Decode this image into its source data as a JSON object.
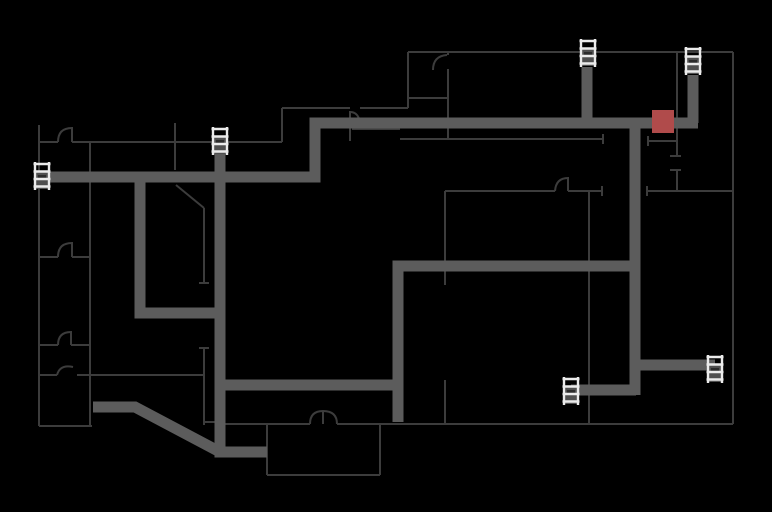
{
  "screen": {
    "kind": "game-automap",
    "width": 772,
    "height": 512
  },
  "map": {
    "colors": {
      "background": "#000000",
      "wall": "#3c3c3c",
      "path": "#5c5c5c",
      "ladder": "#ebebeb",
      "ladder_inner": "#4f4f4f",
      "ladder_slot": "#2b2b2b",
      "marker": "#b04b4b"
    },
    "wall_width": 2,
    "path_width": 11,
    "walls": [
      [
        39,
        125,
        39,
        426
      ],
      [
        39,
        142,
        58,
        142
      ],
      [
        72,
        142,
        282,
        142
      ],
      [
        39,
        257,
        58,
        257
      ],
      [
        72,
        257,
        90,
        257
      ],
      [
        39,
        345,
        58,
        345
      ],
      [
        71,
        345,
        90,
        345
      ],
      [
        39,
        375,
        57,
        375
      ],
      [
        77,
        375,
        203,
        375
      ],
      [
        39,
        426,
        92,
        426
      ],
      [
        90,
        142,
        90,
        426
      ],
      [
        175,
        123,
        175,
        170
      ],
      [
        176,
        185,
        204,
        208
      ],
      [
        204,
        208,
        204,
        283
      ],
      [
        199,
        283,
        209,
        283
      ],
      [
        204,
        348,
        204,
        425
      ],
      [
        199,
        348,
        209,
        348
      ],
      [
        204,
        422,
        217,
        422
      ],
      [
        282,
        108,
        282,
        142
      ],
      [
        282,
        108,
        350,
        108
      ],
      [
        360,
        108,
        408,
        108
      ],
      [
        352,
        129,
        400,
        129
      ],
      [
        408,
        52,
        408,
        108
      ],
      [
        408,
        98,
        448,
        98
      ],
      [
        448,
        52,
        448,
        55
      ],
      [
        448,
        69,
        448,
        138
      ],
      [
        400,
        139,
        603,
        139
      ],
      [
        603,
        134,
        603,
        144
      ],
      [
        408,
        52,
        733,
        52
      ],
      [
        677,
        52,
        677,
        156
      ],
      [
        670,
        156,
        681,
        156
      ],
      [
        670,
        170,
        681,
        170
      ],
      [
        677,
        170,
        677,
        191
      ],
      [
        648,
        141,
        677,
        141
      ],
      [
        648,
        136,
        648,
        146
      ],
      [
        648,
        191,
        733,
        191
      ],
      [
        647,
        186,
        647,
        196
      ],
      [
        733,
        52,
        733,
        424
      ],
      [
        445,
        191,
        445,
        285
      ],
      [
        445,
        380,
        445,
        424
      ],
      [
        445,
        191,
        555,
        191
      ],
      [
        568,
        191,
        602,
        191
      ],
      [
        602,
        186,
        602,
        196
      ],
      [
        589,
        191,
        589,
        424
      ],
      [
        225,
        424,
        310,
        424
      ],
      [
        337,
        424,
        733,
        424
      ],
      [
        267,
        424,
        267,
        475
      ],
      [
        380,
        424,
        380,
        475
      ],
      [
        267,
        475,
        380,
        475
      ],
      [
        323,
        411,
        323,
        424
      ]
    ],
    "doors": [
      "M58 142 Q58 128 72 128 L72 142",
      "M58 257 Q58 243 72 243 L72 257",
      "M58 345 Q58 332 71 332 L71 345",
      "M57 375 Q60 364 73 367",
      "M350 141 L350 112 Q358 112 360 122",
      "M447 55 Q433 56 433 70",
      "M555 191 Q556 178 568 178 L568 191",
      "M310 424 Q310 411 323 411",
      "M337 424 Q337 411 323 411"
    ],
    "paths": [
      "M42 177 H315 V123 H698",
      "M587 67 V123",
      "M693 75 V123",
      "M140 177 V313 H220",
      "M220 150 V452 H267",
      "M93 407 H135 L220 452",
      "M220 385 H398",
      "M398 422 V266 H636",
      "M635 123 V395",
      "M571 390 H636",
      "M635 365 H715"
    ],
    "ladders": [
      {
        "cx": 42,
        "top": 162
      },
      {
        "cx": 220,
        "top": 127
      },
      {
        "cx": 588,
        "top": 39
      },
      {
        "cx": 693,
        "top": 47
      },
      {
        "cx": 571,
        "top": 377
      },
      {
        "cx": 715,
        "top": 355
      }
    ],
    "marker": {
      "x": 652,
      "y": 110,
      "w": 22,
      "h": 23
    }
  }
}
